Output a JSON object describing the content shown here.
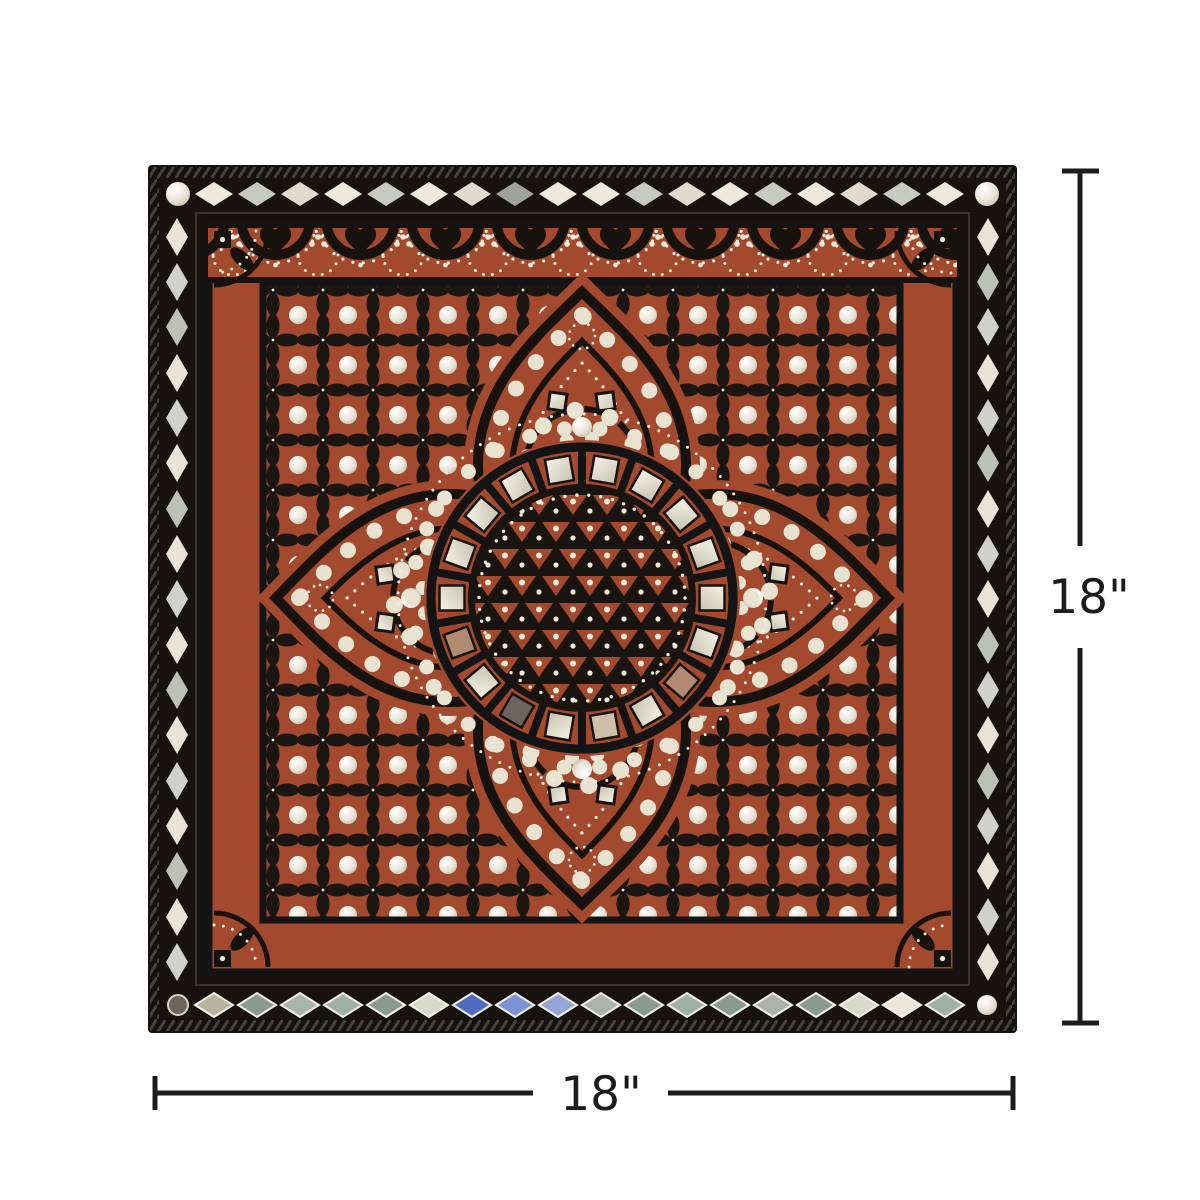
{
  "page": {
    "background": "#ffffff",
    "description": "Handcrafted square Lippan mud-and-mirror-work wall art panel in terracotta, black and ivory with mirror inlays, shown with size annotations"
  },
  "artwork": {
    "style": "lippan-mirror-inlay-panel",
    "palette": {
      "frame_black": "#17120e",
      "terracotta_red": "#a2492e",
      "ivory_dots": "#f2ead8",
      "mirror_silver": "#e8e6da",
      "mirror_green_grey": "#8a9a90",
      "mirror_blue": "#5f7bc8",
      "mirror_copper": "#b28a72"
    }
  },
  "dimensions": {
    "height_label": "18\"",
    "width_label": "18\"",
    "line_color": "#1c1c1c"
  }
}
